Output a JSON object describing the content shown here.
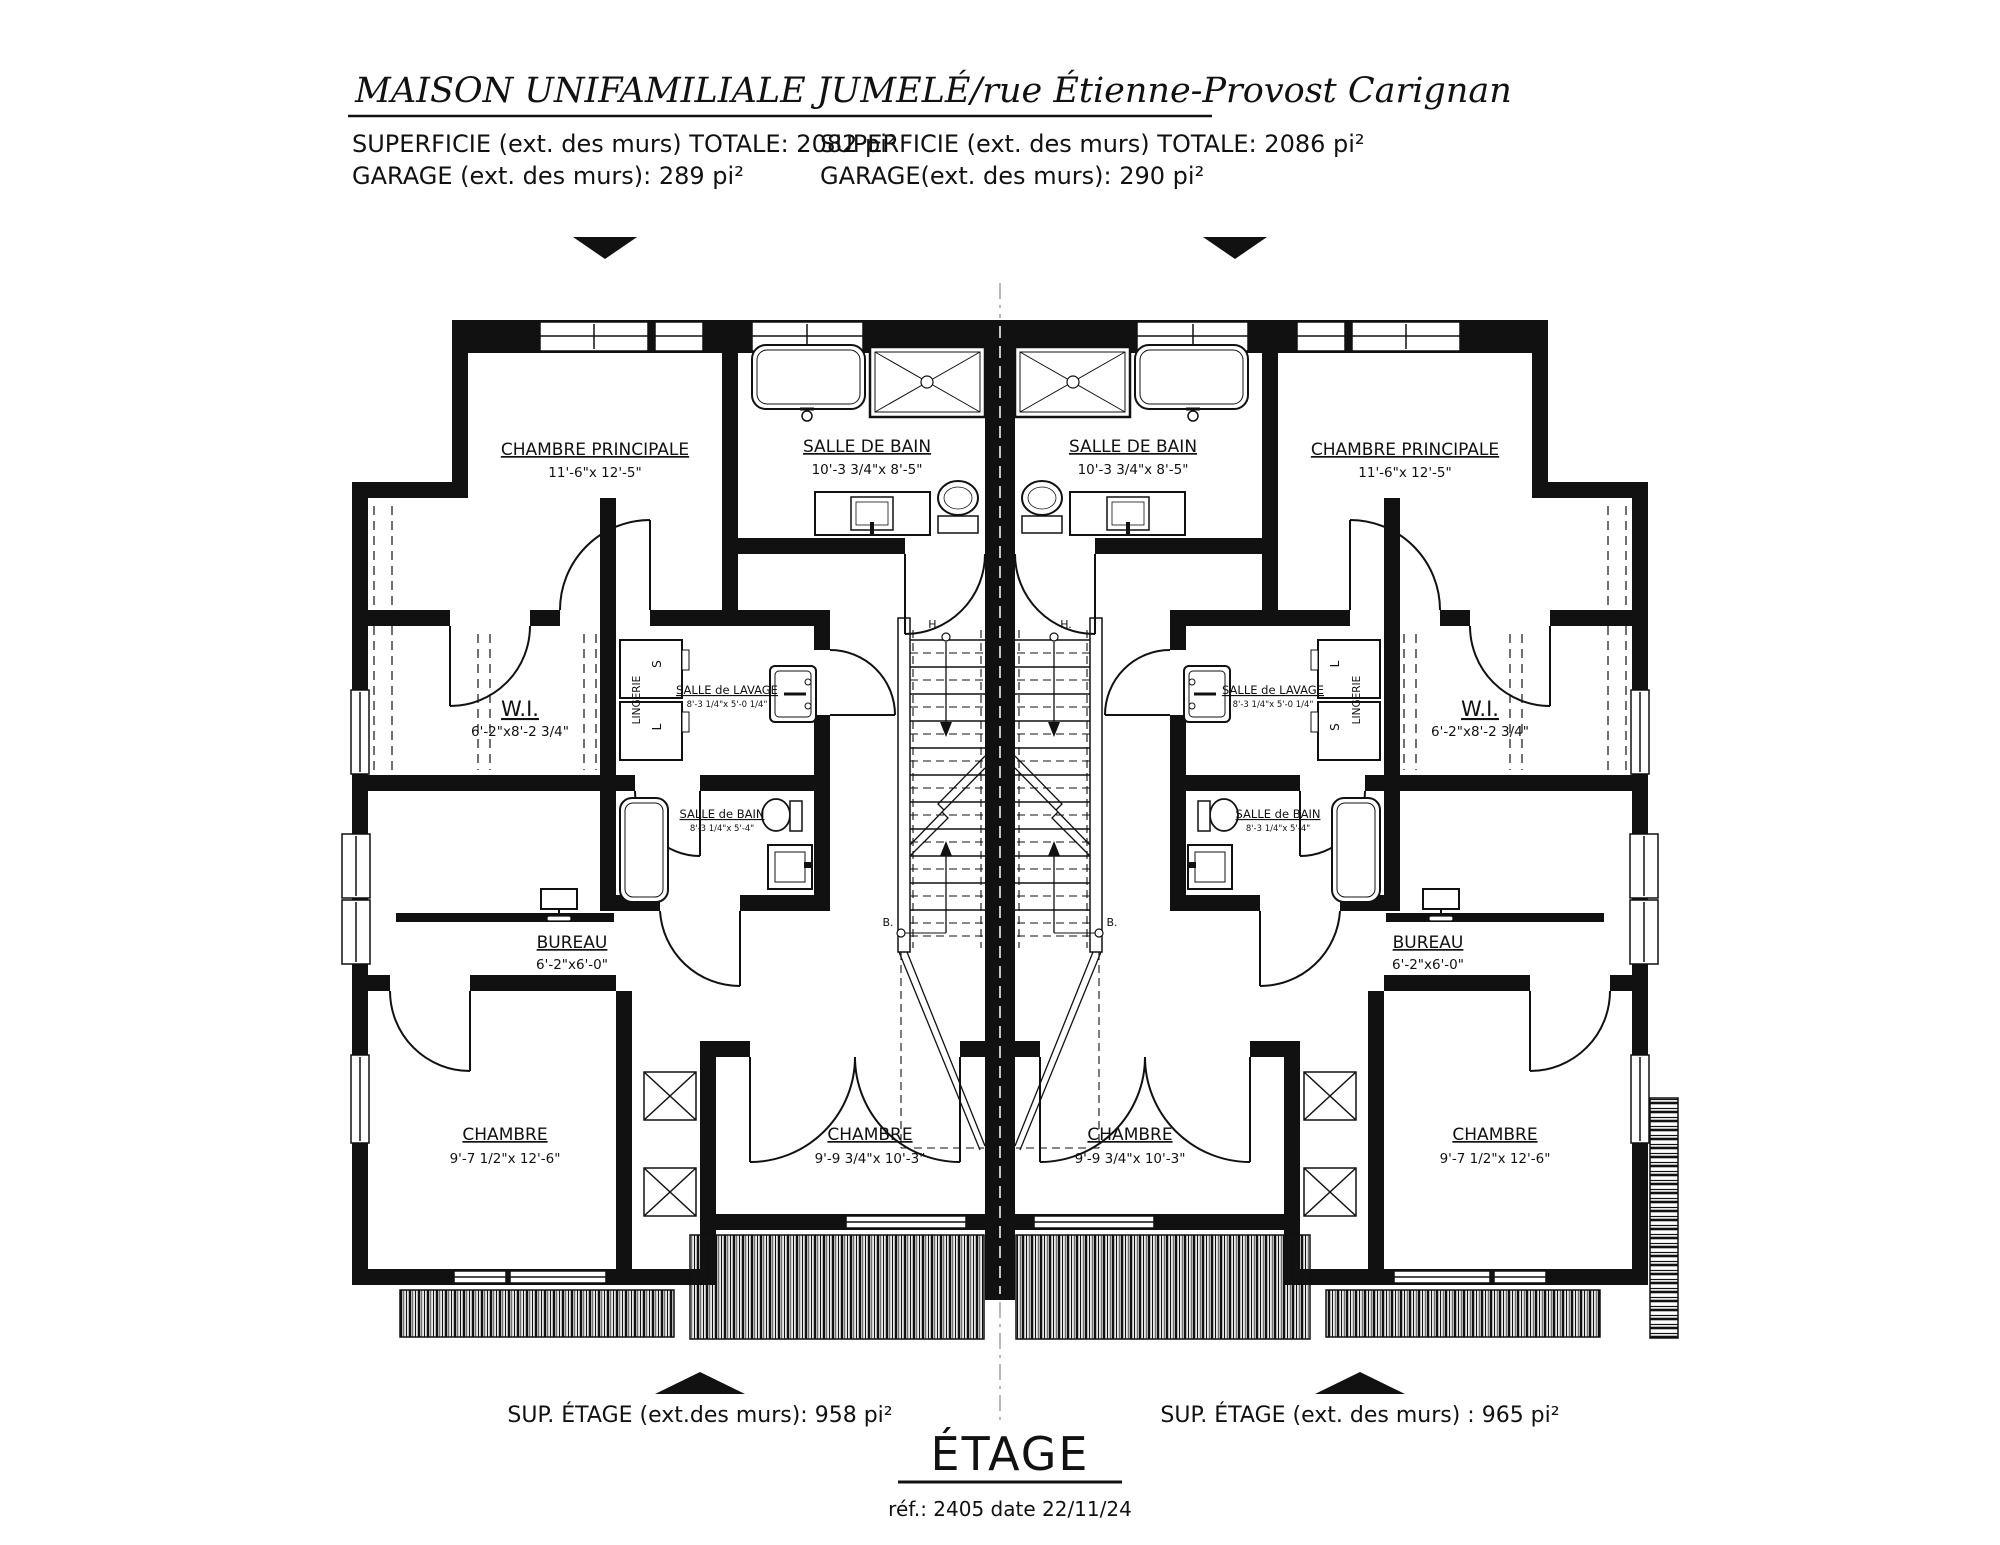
{
  "header": {
    "title": "MAISON  UNIFAMILIALE JUMELÉ/rue Étienne-Provost Carignan",
    "unit_left": {
      "superficie": "SUPERFICIE  (ext. des murs) TOTALE: 2082 pi²",
      "garage": "GARAGE (ext. des murs): 289 pi²"
    },
    "unit_right": {
      "superficie": "SUPERFICIE (ext. des murs) TOTALE: 2086 pi²",
      "garage": "GARAGE(ext. des murs): 290 pi²"
    }
  },
  "plan": {
    "floor_label": "ÉTAGE",
    "left": {
      "chambre_principale": {
        "name": "CHAMBRE PRINCIPALE",
        "dim": "11'-6\"x 12'-5\""
      },
      "salle_de_bain": {
        "name": "SALLE DE BAIN",
        "dim": "10'-3 3/4\"x 8'-5\""
      },
      "wi": {
        "name": "W.I.",
        "dim": "6'-2\"x8'-2 3/4\""
      },
      "lingerie": "LINGERIE",
      "secheuse": "S",
      "laveuse": "L",
      "salle_de_lavage": {
        "name": "SALLE de LAVAGE",
        "dim": "8'-3 1/4\"x 5'-0 1/4\""
      },
      "salle_de_bain_2": {
        "name": "SALLE de BAIN",
        "dim": "8'-3 1/4\"x 5'-4\""
      },
      "bureau": {
        "name": "BUREAU",
        "dim": "6'-2\"x6'-0\""
      },
      "chambre_1": {
        "name": "CHAMBRE",
        "dim": "9'-7 1/2\"x 12'-6\""
      },
      "chambre_2": {
        "name": "CHAMBRE",
        "dim": "9'-9 3/4\"x 10'-3\""
      },
      "stair_haut": "H.",
      "stair_bas": "B."
    },
    "right": {
      "chambre_principale": {
        "name": "CHAMBRE PRINCIPALE",
        "dim": "11'-6\"x 12'-5\""
      },
      "salle_de_bain": {
        "name": "SALLE DE BAIN",
        "dim": "10'-3 3/4\"x 8'-5\""
      },
      "wi": {
        "name": "W.I.",
        "dim": "6'-2\"x8'-2 3/4\""
      },
      "lingerie": "LINGERIE",
      "secheuse": "S",
      "laveuse": "L",
      "salle_de_lavage": {
        "name": "SALLE de LAVAGE",
        "dim": "8'-3 1/4\"x 5'-0 1/4\""
      },
      "salle_de_bain_2": {
        "name": "SALLE de BAIN",
        "dim": "8'-3 1/4\"x 5'-4\""
      },
      "bureau": {
        "name": "BUREAU",
        "dim": "6'-2\"x6'-0\""
      },
      "chambre_1": {
        "name": "CHAMBRE",
        "dim": "9'-7 1/2\"x 12'-6\""
      },
      "chambre_2": {
        "name": "CHAMBRE",
        "dim": "9'-9 3/4\"x 10'-3\""
      },
      "stair_haut": "H.",
      "stair_bas": "B."
    }
  },
  "footer": {
    "sup_left": "SUP. ÉTAGE (ext.des murs):  958 pi²",
    "sup_right": "SUP. ÉTAGE (ext. des murs) :  965 pi²",
    "ref": "réf.: 2405 date 22/11/24"
  },
  "colors": {
    "ink": "#111111",
    "paper": "#ffffff"
  }
}
